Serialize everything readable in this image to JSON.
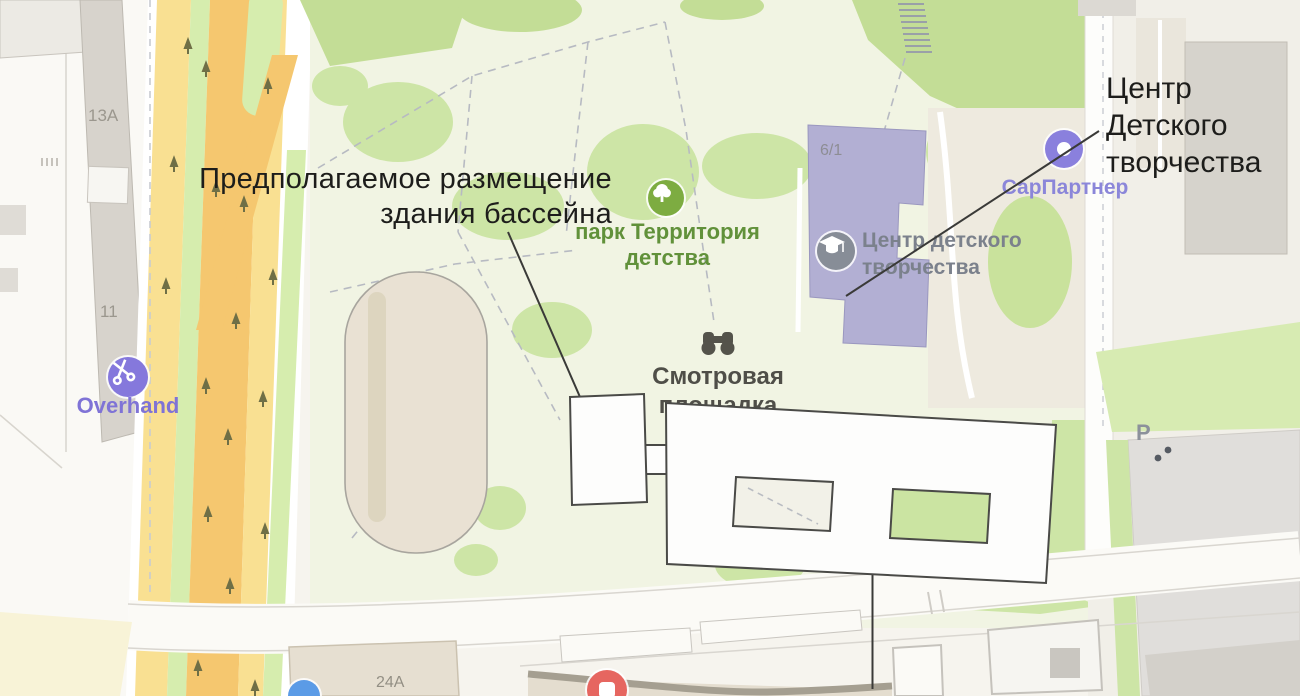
{
  "annotations": {
    "pool_label_line1": "Предполагаемое размещение",
    "pool_label_line2": "здания бассейна",
    "cdt_label_line1": "Центр",
    "cdt_label_line2": "Детского",
    "cdt_label_line3": "творчества"
  },
  "map_labels": {
    "park_line1": "парк Территория",
    "park_line2": "детства",
    "children_center_line1": "Центр детского",
    "children_center_line2": "творчества",
    "viewpoint_line1": "Смотровая",
    "viewpoint_line2": "площадка",
    "overhand": "Overhand",
    "sarpartner": "СарПартнер",
    "building_13a": "13А",
    "building_11": "11",
    "building_6_1": "6/1",
    "building_24a": "24А",
    "parking": "P"
  },
  "icons": {
    "park": "tree-icon",
    "children_center": "graduation-cap-icon",
    "viewpoint": "binoculars-icon",
    "overhand": "scissors-icon",
    "sarpartner": "donut-icon",
    "shop": "shop-pin-icon",
    "bottom_left": "blue-pin-icon"
  },
  "colors": {
    "map_base": "#f6f4ee",
    "park_base": "#f1f4e3",
    "park_green": "#cde5a6",
    "road_orange": "#f5c76f",
    "road_yellow": "#f9e092",
    "road_green": "#d6edae",
    "stadium_beige": "#e9e1d3",
    "building_lavender": "#b2afd3",
    "poi_purple": "#8578dc",
    "park_text_green": "#61913a",
    "poi_gray_text": "#7b818c",
    "annotation_text": "#1d1d1b",
    "proposal_fill": "#fdfdfc",
    "proposal_stroke": "#4a4a47",
    "leader_line": "#3a3a38",
    "shop_red": "#e66660",
    "pin_blue": "#5b9be6"
  }
}
